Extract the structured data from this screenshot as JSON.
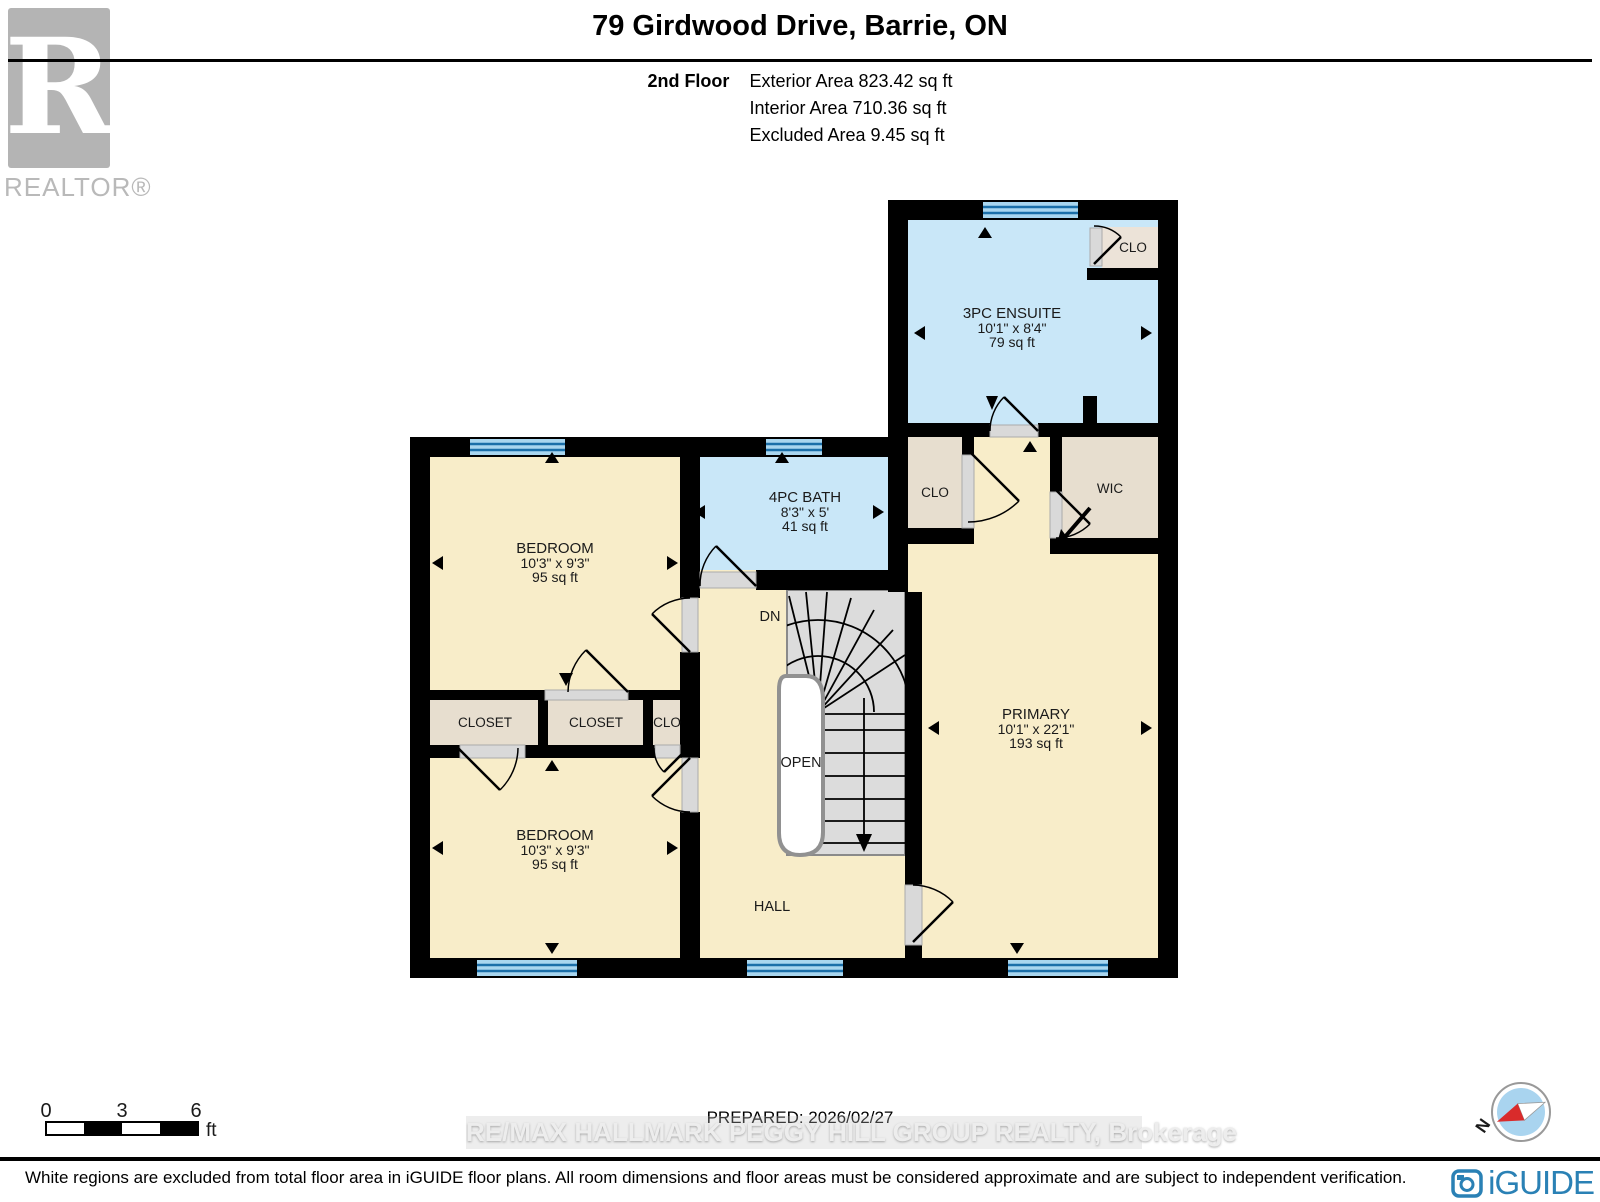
{
  "header": {
    "title": "79 Girdwood Drive, Barrie, ON",
    "floor_label": "2nd Floor",
    "stats": [
      "Exterior Area 823.42 sq ft",
      "Interior Area 710.36 sq ft",
      "Excluded Area 9.45 sq ft"
    ]
  },
  "branding": {
    "realtor_letter": "R",
    "realtor_text": "REALTOR®",
    "iguide_text": "iGUIDE"
  },
  "compass": {
    "north": "N"
  },
  "rooms": {
    "ensuite": {
      "name": "3PC ENSUITE",
      "dims": "10'1\" x 8'4\"",
      "area": "79 sq ft"
    },
    "bath": {
      "name": "4PC BATH",
      "dims": "8'3\" x 5'",
      "area": "41 sq ft"
    },
    "bedroom_top": {
      "name": "BEDROOM",
      "dims": "10'3\" x 9'3\"",
      "area": "95 sq ft"
    },
    "bedroom_bottom": {
      "name": "BEDROOM",
      "dims": "10'3\" x 9'3\"",
      "area": "95 sq ft"
    },
    "primary": {
      "name": "PRIMARY",
      "dims": "10'1\" x 22'1\"",
      "area": "193 sq ft"
    },
    "closet_left": {
      "name": "CLOSET"
    },
    "closet_mid": {
      "name": "CLOSET"
    },
    "clo_hall": {
      "name": "CLO"
    },
    "clo_mid": {
      "name": "CLO"
    },
    "clo_ensuite": {
      "name": "CLO"
    },
    "wic": {
      "name": "WIC"
    },
    "hall": {
      "name": "HALL"
    },
    "stairs_down": {
      "name": "DN"
    },
    "open_below": {
      "name": "OPEN"
    }
  },
  "scale_bar": {
    "labels": [
      "0",
      "3",
      "6"
    ],
    "unit": "ft"
  },
  "footer": {
    "prepared": "PREPARED: 2026/02/27",
    "watermark": "RE/MAX HALLMARK PEGGY HILL GROUP REALTY, Brokerage",
    "disclaimer": "White regions are excluded from total floor area in iGUIDE floor plans. All room dimensions and floor areas must be considered approximate and are subject to independent verification."
  },
  "colors": {
    "room_cream": "#f8edc9",
    "wet_room_blue": "#c9e7f8",
    "closet_beige": "#e7decf",
    "window_fill": "#a9d6ef",
    "window_line": "#1b6fa9",
    "stair_gray": "#dcdcdc",
    "wall_black": "#000000",
    "iguide_blue": "#2a81b5",
    "compass_red": "#d92b2b",
    "compass_blue": "#a9d4ef"
  }
}
